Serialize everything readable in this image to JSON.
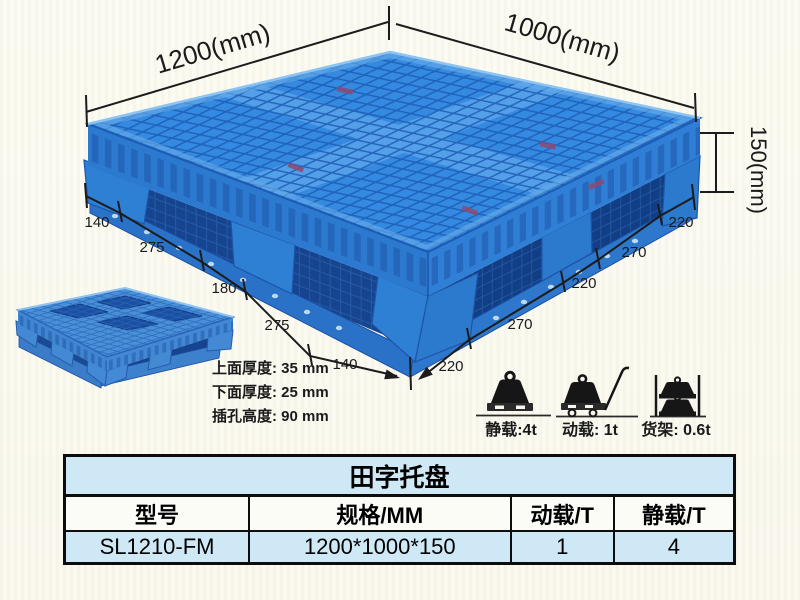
{
  "diagram": {
    "length_label": "1200(mm)",
    "width_label": "1000(mm)",
    "height_label": "150(mm)",
    "left_dims": [
      "140",
      "275",
      "180",
      "275",
      "140"
    ],
    "right_dims": [
      "220",
      "270",
      "220",
      "270",
      "220"
    ],
    "notes": [
      "上面厚度: 35 mm",
      "下面厚度: 25 mm",
      "插孔高度: 90 mm"
    ]
  },
  "load_ratings": [
    {
      "icon": "static-load-icon",
      "label": "静载:4t"
    },
    {
      "icon": "dynamic-load-icon",
      "label": "动载: 1t"
    },
    {
      "icon": "rack-load-icon",
      "label": "货架: 0.6t"
    }
  ],
  "table": {
    "title": "田字托盘",
    "headers": [
      "型号",
      "规格/MM",
      "动载/T",
      "静载/T"
    ],
    "rows": [
      [
        "SL1210-FM",
        "1200*1000*150",
        "1",
        "4"
      ]
    ]
  },
  "colors": {
    "pallet_blue": "#3489e0",
    "pallet_dark_hole": "#16448f",
    "pallet_highlight": "#8ec4f2",
    "table_row_bg": "#cfe8f6",
    "ink": "#1a1a1a",
    "tag_red": "#8e4a72"
  }
}
